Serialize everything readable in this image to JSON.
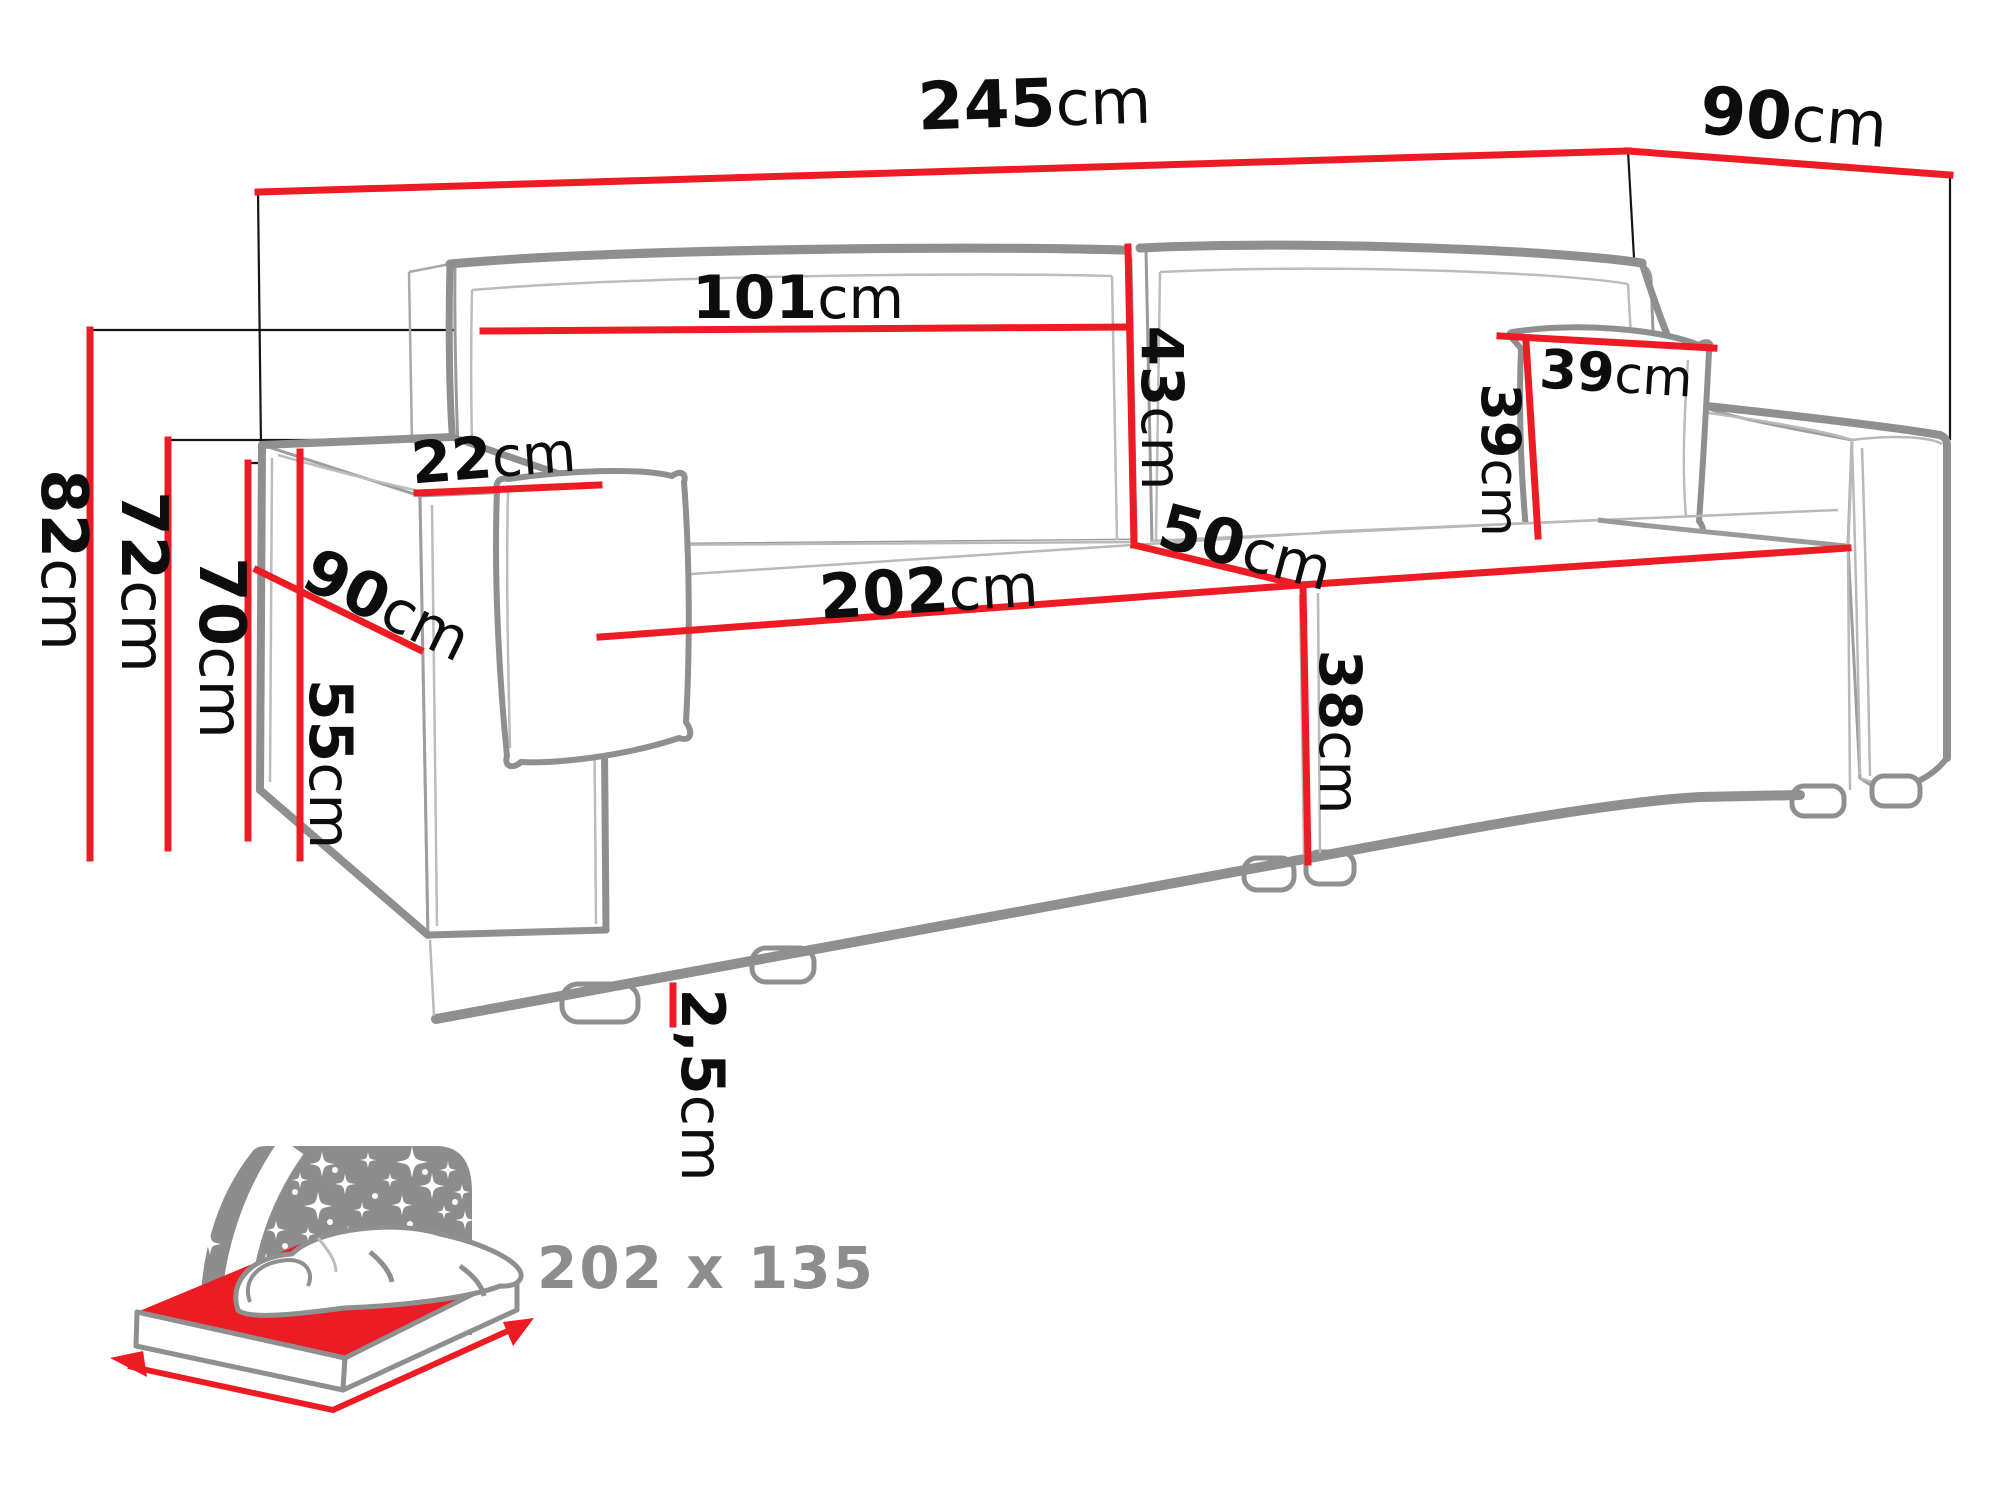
{
  "diagram": {
    "type": "sofa-dimension-technical-drawing",
    "unit_default": "cm",
    "colors": {
      "dimension_line": "#ed1b24",
      "label_text": "#0d0d0d",
      "sofa_outline": "#8f8f8f",
      "sofa_detail_line": "#b9b9b9",
      "icon_gray": "#8d8d8d"
    }
  },
  "dims": {
    "w_total": {
      "num": "245",
      "unit": "cm"
    },
    "d_total": {
      "num": "90",
      "unit": "cm"
    },
    "h_total": {
      "num": "82",
      "unit": "cm"
    },
    "h_backrest": {
      "num": "72",
      "unit": "cm"
    },
    "h_armrest": {
      "num": "70",
      "unit": "cm"
    },
    "h_armrest_side": {
      "num": "55",
      "unit": "cm"
    },
    "d_armrest": {
      "num": "90",
      "unit": "cm"
    },
    "w_armrest_top": {
      "num": "22",
      "unit": "cm"
    },
    "w_back_cushion": {
      "num": "101",
      "unit": "cm"
    },
    "h_back_cushion": {
      "num": "43",
      "unit": "cm"
    },
    "w_pillow": {
      "num": "39",
      "unit": "cm"
    },
    "h_pillow": {
      "num": "39",
      "unit": "cm"
    },
    "d_seat": {
      "num": "50",
      "unit": "cm"
    },
    "w_seat": {
      "num": "202",
      "unit": "cm"
    },
    "h_seat": {
      "num": "38",
      "unit": "cm"
    },
    "h_leg": {
      "num": "2,5",
      "unit": "cm"
    }
  },
  "bed": {
    "label": "202 x 135",
    "icon": "sleeping-function-starry-night-mattress-icon"
  }
}
